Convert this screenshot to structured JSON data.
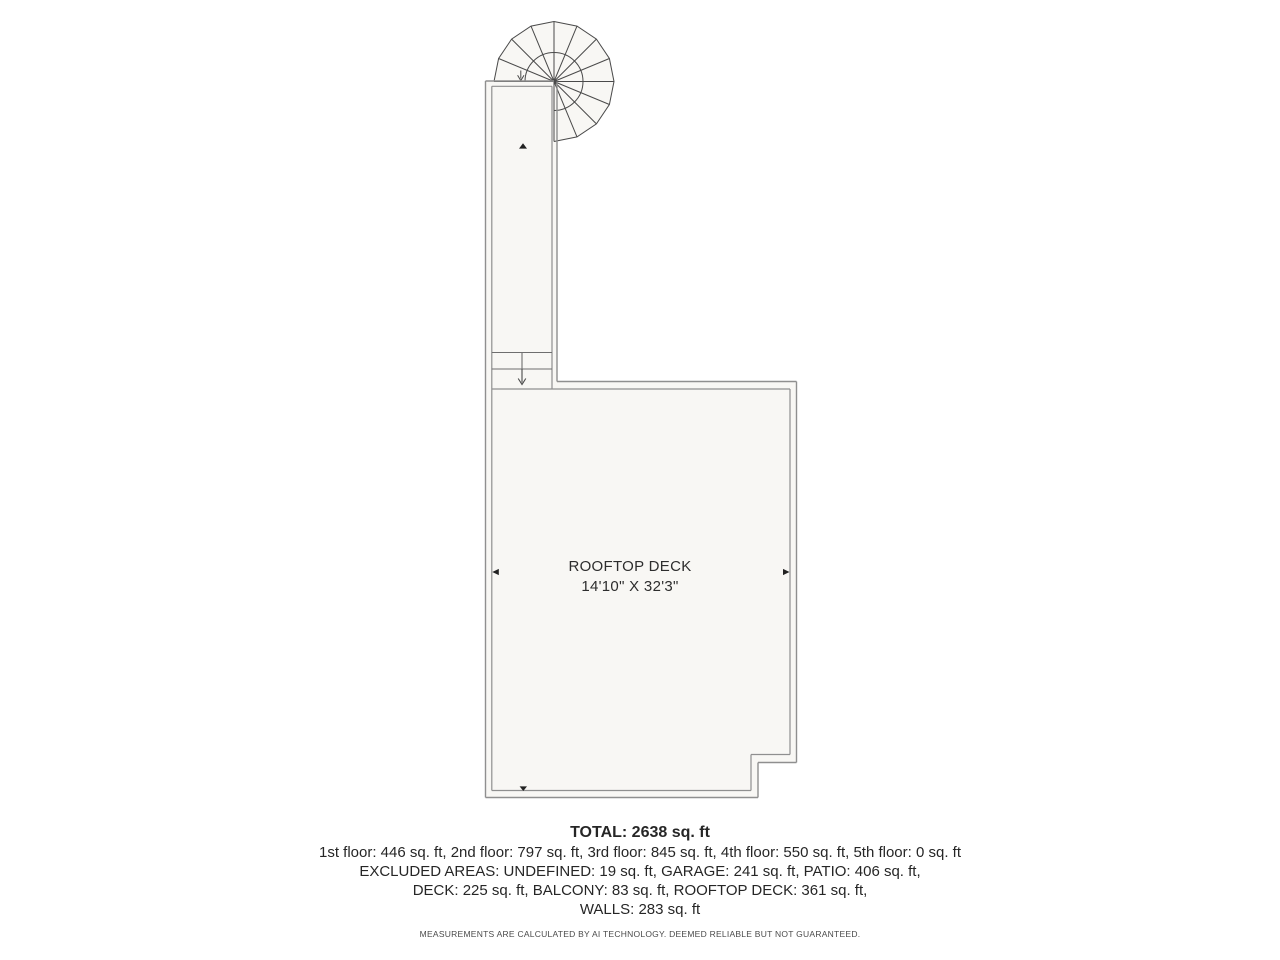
{
  "colors": {
    "background": "#ffffff",
    "interior_fill": "#f8f7f4",
    "wall_line": "#8f8f8f",
    "stair_line": "#4a4a4a",
    "tread_line": "#6e6e6e",
    "marker_fill": "#222222",
    "text": "#262626",
    "disclaimer_text": "#4a4a4a"
  },
  "floor_plan": {
    "room_label": {
      "name": "ROOFTOP DECK",
      "dimensions": "14'10\" X 32'3\""
    },
    "summary": {
      "total": "TOTAL: 2638 sq. ft",
      "floors": "1st floor: 446 sq. ft, 2nd floor: 797 sq. ft, 3rd floor: 845 sq. ft, 4th floor: 550 sq. ft, 5th floor: 0 sq. ft",
      "excluded_areas": "EXCLUDED AREAS: UNDEFINED: 19 sq. ft, GARAGE: 241 sq. ft, PATIO: 406 sq. ft,",
      "decks": "DECK: 225 sq. ft, BALCONY: 83 sq. ft, ROOFTOP DECK: 361 sq. ft,",
      "walls": "WALLS: 283 sq. ft",
      "disclaimer": "MEASUREMENTS ARE CALCULATED BY AI TECHNOLOGY. DEEMED RELIABLE BUT NOT GUARANTEED."
    },
    "icons": {
      "spiral_staircase": "spiral-staircase-icon",
      "stair_down_arrow": "stair-down-arrow-icon",
      "spiral_entry_arrow": "spiral-entry-arrow-icon",
      "corridor_up_marker": "up-triangle-marker-icon",
      "left_wall_marker": "left-wall-marker-icon",
      "right_wall_marker": "right-wall-marker-icon",
      "bottom_wall_marker": "bottom-wall-marker-icon"
    }
  }
}
